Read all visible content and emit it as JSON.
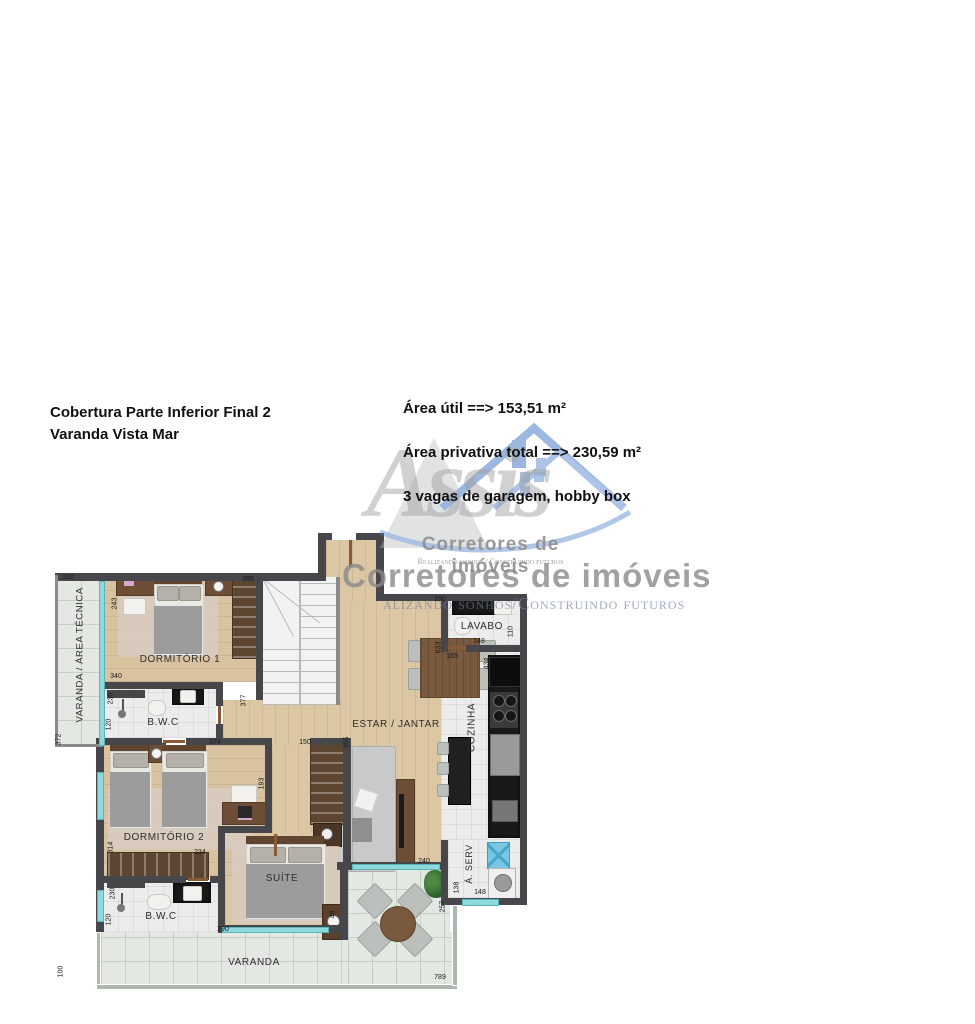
{
  "header": {
    "title_line1": "Cobertura Parte Inferior Final 2",
    "title_line2": "Varanda Vista Mar",
    "info_line1": "Área útil ==> 153,51 m²",
    "info_line2": "Área privativa total ==> 230,59 m²",
    "info_line3": "3 vagas de garagem, hobby box"
  },
  "watermark": {
    "brand": "Assis",
    "subtitle_small": "Corretores de imóveis",
    "tagline_small": "Realizando sonhos / Construindo futuros",
    "subtitle_large": "Corretores de imóveis",
    "tagline_large": "alizando sonhos/Construindo futuros",
    "brand_color": "#a0a0a0",
    "roof_color": "#4e7fc7"
  },
  "plan": {
    "rooms": [
      {
        "label": "VARANDA / ÁREA TÉCNICA"
      },
      {
        "label": "DORMITÓRIO 1"
      },
      {
        "label": "B.W.C"
      },
      {
        "label": "ESTAR / JANTAR"
      },
      {
        "label": "LAVABO"
      },
      {
        "label": "COZINHA"
      },
      {
        "label": "Á. SERV"
      },
      {
        "label": "DORMITÓRIO 2"
      },
      {
        "label": "B.W.C"
      },
      {
        "label": "SUÍTE"
      },
      {
        "label": "VARANDA"
      }
    ],
    "measurements": [
      {
        "v": "100"
      },
      {
        "v": "243"
      },
      {
        "v": "289"
      },
      {
        "v": "190"
      },
      {
        "v": "110"
      },
      {
        "v": "148"
      },
      {
        "v": "633"
      },
      {
        "v": "165"
      },
      {
        "v": "434"
      },
      {
        "v": "340"
      },
      {
        "v": "230"
      },
      {
        "v": "377"
      },
      {
        "v": "120"
      },
      {
        "v": "372"
      },
      {
        "v": "374"
      },
      {
        "v": "150"
      },
      {
        "v": "305"
      },
      {
        "v": "193"
      },
      {
        "v": "314"
      },
      {
        "v": "234"
      },
      {
        "v": "240"
      },
      {
        "v": "48"
      },
      {
        "v": "230"
      },
      {
        "v": "120"
      },
      {
        "v": "290"
      },
      {
        "v": "138"
      },
      {
        "v": "148"
      },
      {
        "v": "257"
      },
      {
        "v": "100"
      },
      {
        "v": "789"
      }
    ]
  }
}
